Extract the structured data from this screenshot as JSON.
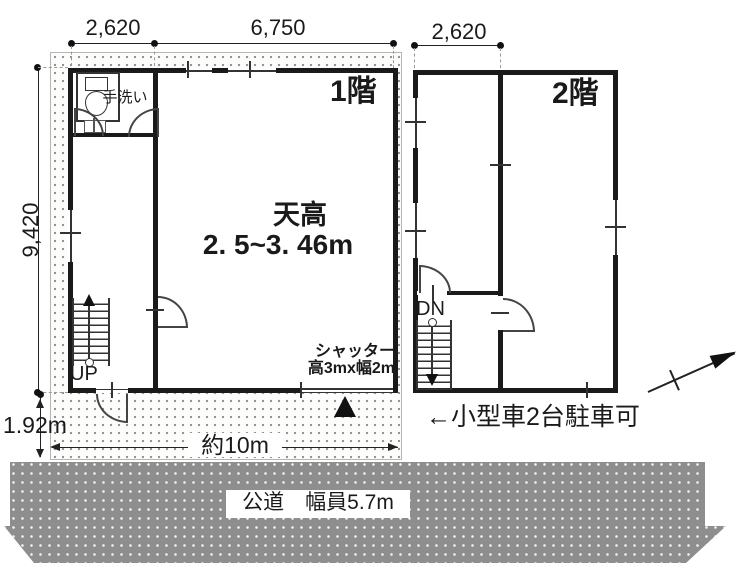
{
  "dimensions": {
    "top_width_left": "2,620",
    "top_width_center": "6,750",
    "top_width_right": "2,620",
    "side_height": "9,420",
    "setback": "1.92m",
    "frontage": "約10m"
  },
  "floor1": {
    "label": "1階",
    "ceiling_title": "天高",
    "ceiling_value": "2. 5~3. 46m",
    "handwash": "手洗い",
    "stairs_up": "UP",
    "shutter_line1": "シャッター",
    "shutter_line2": "高3mx幅2m"
  },
  "floor2": {
    "label": "2階",
    "stairs_down": "DN"
  },
  "annotations": {
    "parking": "←小型車2台駐車可",
    "road": "公道　幅員5.7m"
  },
  "icons": [
    "north-arrow-icon",
    "toilet-icon",
    "entrance-triangle-icon",
    "up-arrow-icon",
    "down-arrow-icon"
  ],
  "colors": {
    "wall": "#1a1a1a",
    "road_fill": "#8e8e8e",
    "land_dot": "#8f8f8f",
    "background": "#ffffff"
  }
}
